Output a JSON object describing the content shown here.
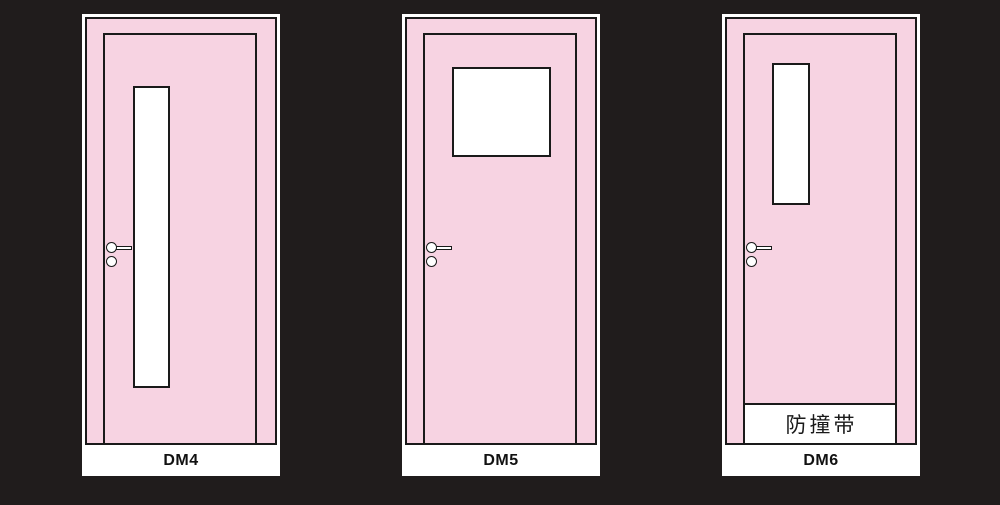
{
  "colors": {
    "bg": "#201c1c",
    "pink": "#f7d3e2",
    "line": "#1a1a1a",
    "white": "#ffffff"
  },
  "doors": [
    {
      "label": "DM4",
      "vision_panel": "tall-narrow-glass"
    },
    {
      "label": "DM5",
      "vision_panel": "square-window"
    },
    {
      "label": "DM6",
      "vision_panel": "short-narrow-glass",
      "strip_label": "防撞带"
    }
  ]
}
